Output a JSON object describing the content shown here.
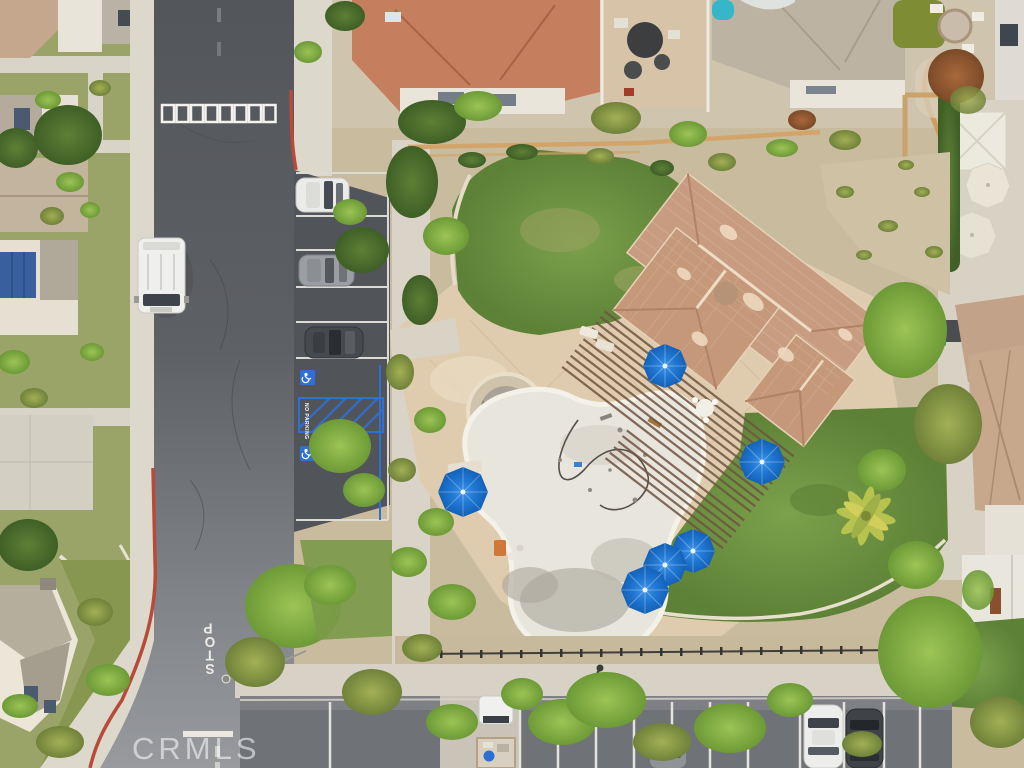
{
  "scene": {
    "kind": "aerial-drone-photo",
    "description": "Top-down aerial view of a residential community: clubhouse with terracotta tile roof and pergola, drained swimming pool and round spa under renovation, tan pool deck with blue patio umbrellas, lawns, street with STOP marking, accessible parking stalls with blue markings, parked cars, surrounding homes and trees"
  },
  "watermark": {
    "text": "CRMLS"
  },
  "road": {
    "stop_marking": "STOP",
    "stop_letters": [
      "S",
      "T",
      "O",
      "P"
    ],
    "no_parking_marking": "NO PARKING"
  },
  "counts": {
    "blue_pool_umbrellas": 6,
    "white_patio_umbrellas": 3,
    "street_bay_parked_cars": 3,
    "street_parked_van": 1,
    "bottom_lot_vehicles": 4,
    "crosswalk_squares": 8,
    "accessible_symbols": 2
  },
  "palette": {
    "asphalt_dark": "#53565b",
    "asphalt_light": "#989a9e",
    "parking_lot": "#6f7277",
    "sidewalk": "#dcd8cc",
    "pool_deck": "#dfcbae",
    "pool_plaster": "#e8e5dc",
    "spa_concrete": "#a9a296",
    "roof_terracotta": "#c89c80",
    "roof_red_tile": "#c57f5f",
    "roof_gray": "#bdb3a2",
    "pergola_wood": "#6f5340",
    "lawn_green": "#6f9644",
    "tree_bright": "#8fbf3f",
    "tree_dark": "#4e7a33",
    "umbrella_blue": "#1f76d2",
    "umbrella_white": "#eae4d6",
    "curb_red": "#b84a3a",
    "accessible_blue": "#2f6fd6",
    "marking_white": "#edebe4",
    "fence_tan": "#d2a469",
    "pool_slide_teal": "#35b6c9",
    "solar_panel_blue": "#3a5f9e"
  }
}
